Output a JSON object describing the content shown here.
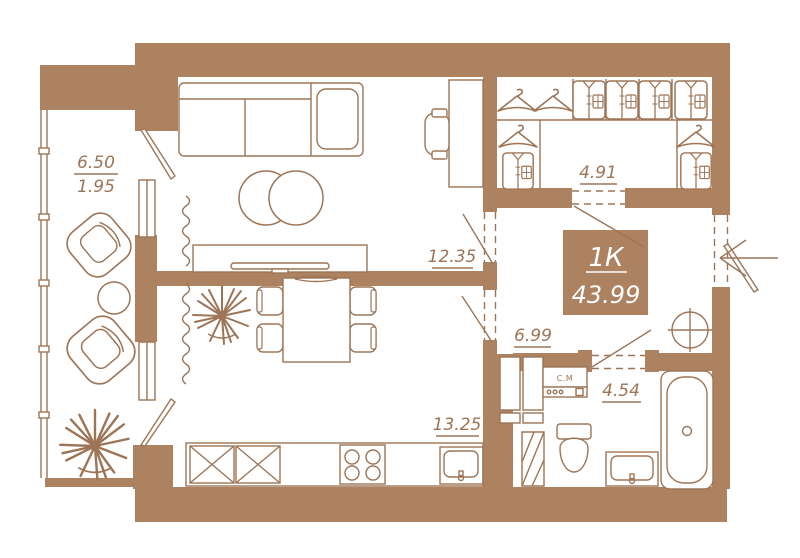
{
  "floor_plan": {
    "unit": {
      "type_label": "1К",
      "total_area": "43.99"
    },
    "rooms": {
      "balcony": {
        "area": "6.50",
        "area_reduced": "1.95"
      },
      "living_room": {
        "area": "12.35"
      },
      "wardrobe": {
        "area": "4.91"
      },
      "hallway": {
        "area": "6.99"
      },
      "bathroom": {
        "area": "4.54"
      },
      "kitchen": {
        "area": "13.25"
      }
    },
    "appliances": {
      "washing_machine_label": "С.М"
    },
    "colors": {
      "wall": "#ac8260",
      "line": "#9d7556",
      "background": "#ffffff",
      "unit_label_bg": "#ac8260",
      "unit_label_text": "#ffffff"
    }
  }
}
